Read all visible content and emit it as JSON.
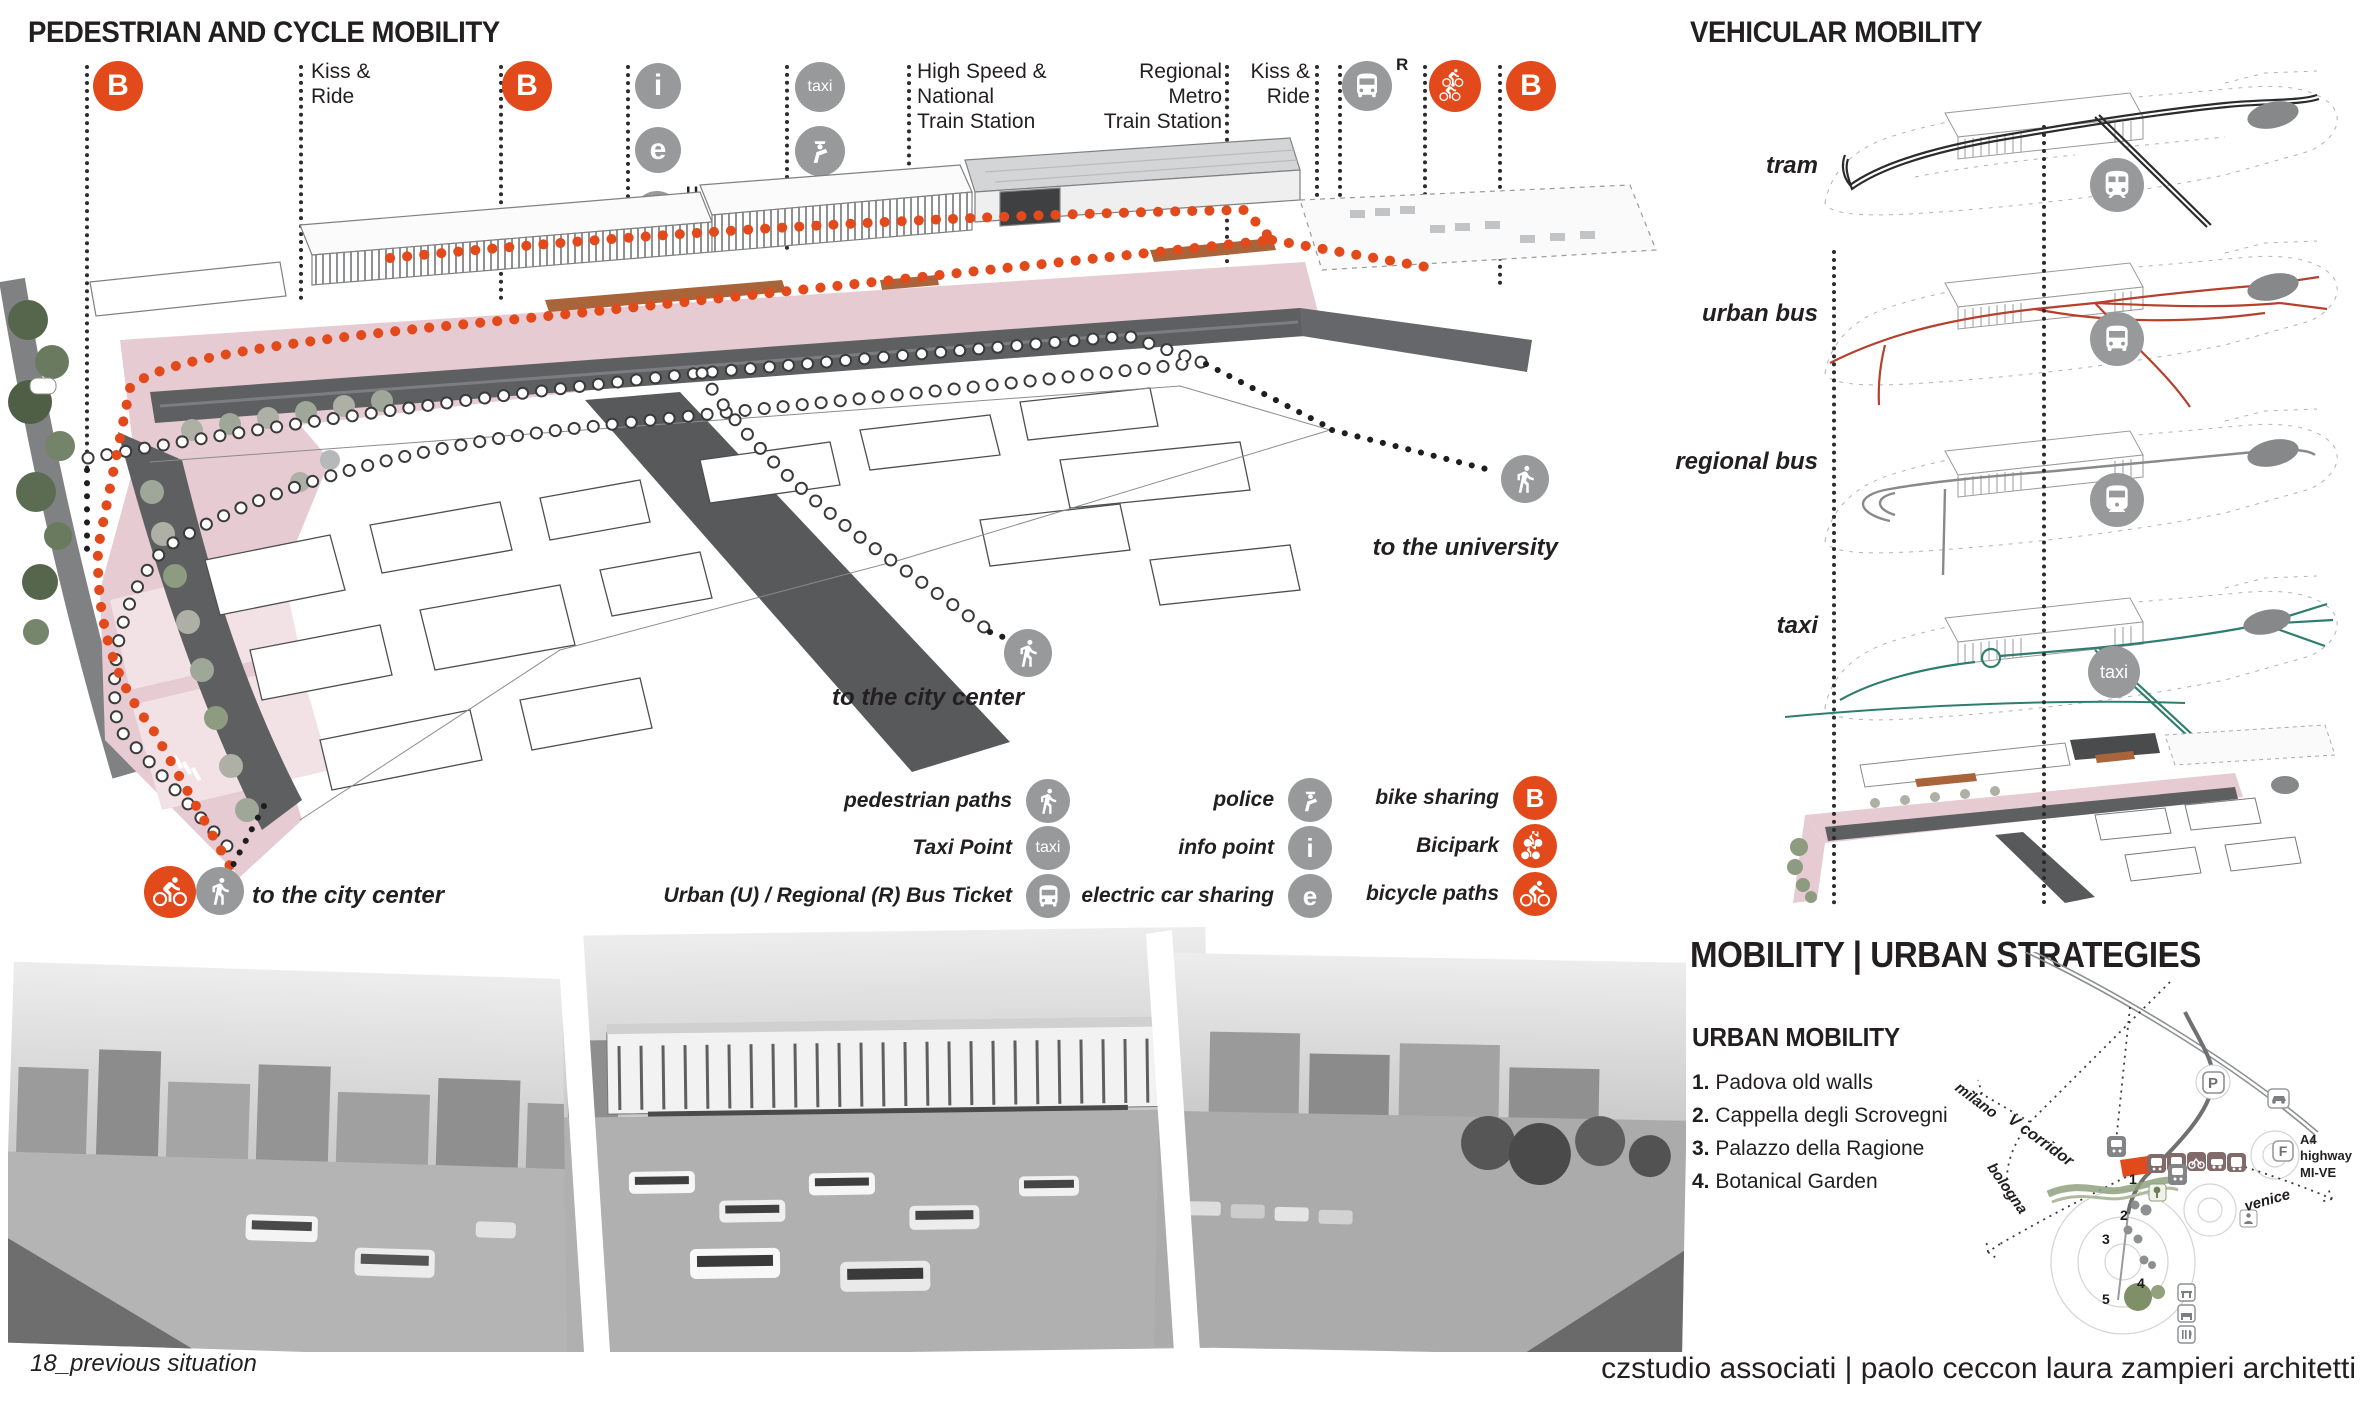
{
  "colors": {
    "accent_orange": "#E2491B",
    "route_red": "#B5402C",
    "route_teal": "#2F7D6F",
    "route_black": "#2B2B2B",
    "route_gray": "#88898B",
    "icon_gray": "#97999B",
    "plaza_pink": "#E6CBD2",
    "road_gray": "#5E5F61",
    "ink": "#231F20"
  },
  "left_panel": {
    "title": "PEDESTRIAN AND CYCLE MOBILITY",
    "annotations": {
      "kiss_ride_1": "Kiss &\nRide",
      "hs_station": "High Speed &\nNational\nTrain Station",
      "regional_station": "Regional\nMetro\nTrain Station",
      "kiss_ride_2": "Kiss &\nRide",
      "b_letter": "B",
      "i_letter": "i",
      "e_letter": "e",
      "taxi_label": "taxi",
      "u_superscript": "U",
      "r_superscript": "R"
    },
    "map_notes": {
      "to_university": "to the university",
      "to_city_center_mid": "to the city center",
      "to_city_center_sw": "to the city center"
    },
    "legend": {
      "col1": [
        {
          "label": "pedestrian paths",
          "icon": "walk-icon"
        },
        {
          "label": "Taxi Point",
          "icon": "taxi-icon",
          "letter": "taxi"
        },
        {
          "label": "Urban (U) / Regional (R) Bus Ticket",
          "icon": "bus-icon"
        }
      ],
      "col2": [
        {
          "label": "police",
          "icon": "police-icon"
        },
        {
          "label": "info point",
          "icon": "info-icon",
          "letter": "i"
        },
        {
          "label": "electric car sharing",
          "icon": "electric-icon",
          "letter": "e"
        }
      ],
      "col3": [
        {
          "label": "bike sharing",
          "icon": "bikeshare-icon",
          "letter": "B"
        },
        {
          "label": "Bicipark",
          "icon": "bicipark-icon"
        },
        {
          "label": "bicycle paths",
          "icon": "bicycle-icon"
        }
      ]
    }
  },
  "right_panel": {
    "title": "VEHICULAR MOBILITY",
    "layers": [
      {
        "label": "tram",
        "color": "#2B2B2B",
        "icon": "tram-icon"
      },
      {
        "label": "urban bus",
        "color": "#B5402C",
        "icon": "bus-icon"
      },
      {
        "label": "regional bus",
        "color": "#88898B",
        "icon": "railway-icon"
      },
      {
        "label": "taxi",
        "color": "#2F7D6F",
        "icon": "taxi-icon"
      }
    ],
    "taxi_circle_label": "taxi"
  },
  "strategies": {
    "title": "MOBILITY | URBAN STRATEGIES",
    "subtitle": "URBAN MOBILITY",
    "items": [
      {
        "num": "1.",
        "text": "Padova old walls"
      },
      {
        "num": "2.",
        "text": "Cappella degli Scrovegni"
      },
      {
        "num": "3.",
        "text": "Palazzo della Ragione"
      },
      {
        "num": "4.",
        "text": "Botanical Garden"
      }
    ],
    "diagram": {
      "milano": "milano",
      "v_corridor": "V corridor",
      "venice": "venice",
      "bologna": "bologna",
      "a4": "A4\nhighway\nMI-VE",
      "p": "P",
      "f": "F",
      "points": [
        "1",
        "2",
        "3",
        "4",
        "5"
      ]
    }
  },
  "footer": {
    "caption": "18_previous situation",
    "credit": "czstudio associati | paolo ceccon laura zampieri architetti"
  }
}
